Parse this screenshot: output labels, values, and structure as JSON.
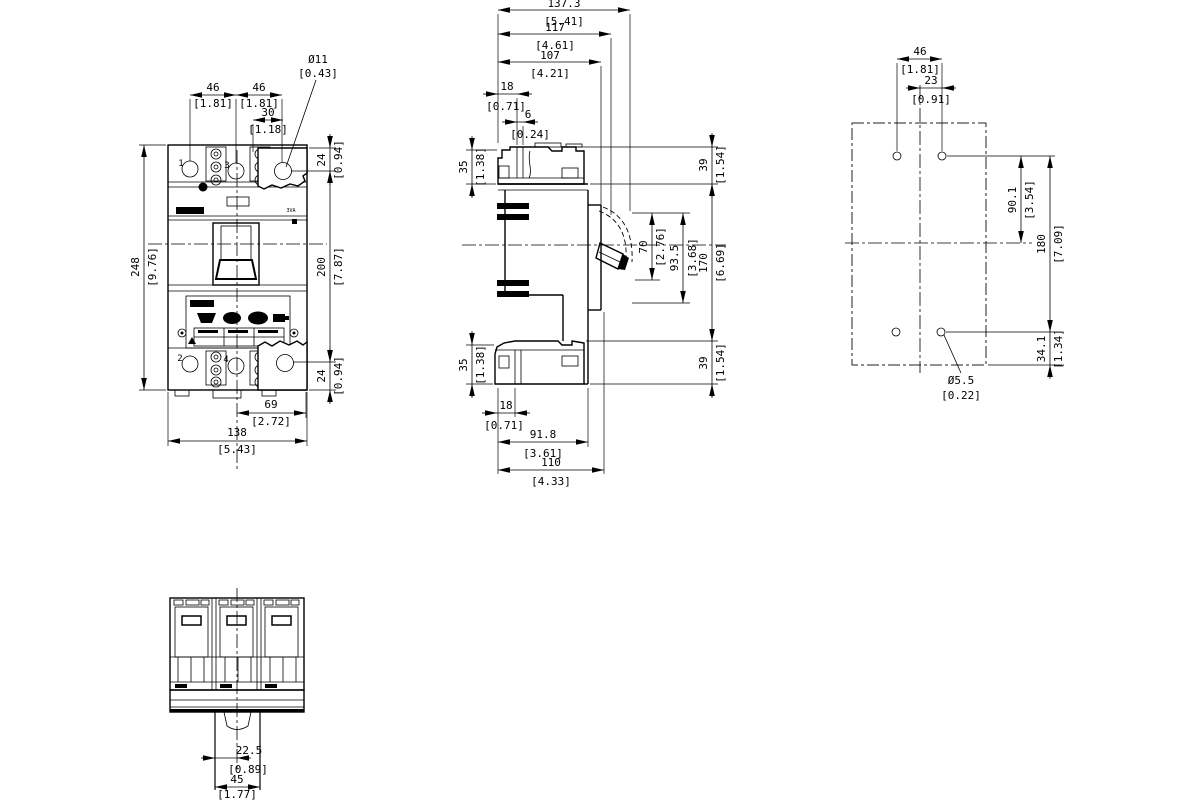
{
  "figure": {
    "type": "technical-dimension-drawing",
    "subject": "3-pole molded case circuit breaker outline drawing: front view, side view, drilling pattern, bottom view",
    "units_note": "dimensions in mm [inch]",
    "line_color": "#000000",
    "background_color": "#ffffff"
  },
  "front_view": {
    "terminals_top": [
      "1",
      "3"
    ],
    "terminals_bottom": [
      "2",
      "4"
    ],
    "product_marking": "3VA",
    "rating_plate_icons": [
      "dsub-connector-icon",
      "round-connector-icon",
      "round-connector-icon",
      "terminal-plug-icon",
      "warning-triangle-icon"
    ],
    "dims": {
      "pitch_left": {
        "mm": "46",
        "inch": "[1.81]"
      },
      "pitch_right": {
        "mm": "46",
        "inch": "[1.81]"
      },
      "ear_hole_offset": {
        "mm": "30",
        "inch": "[1.18]"
      },
      "ear_hole_dia": {
        "mm": "Ø11",
        "inch": "[0.43]"
      },
      "ear_top": {
        "mm": "24",
        "inch": "[0.94]"
      },
      "ear_bottom": {
        "mm": "24",
        "inch": "[0.94]"
      },
      "height_overall": {
        "mm": "248",
        "inch": "[9.76]"
      },
      "height_mounting": {
        "mm": "200",
        "inch": "[7.87]"
      },
      "width_half": {
        "mm": "69",
        "inch": "[2.72]"
      },
      "width_overall": {
        "mm": "138",
        "inch": "[5.43]"
      }
    }
  },
  "side_view": {
    "dims": {
      "depth_overall": {
        "mm": "137.3",
        "inch": "[5.41]"
      },
      "depth_117": {
        "mm": "117",
        "inch": "[4.61]"
      },
      "depth_107": {
        "mm": "107",
        "inch": "[4.21]"
      },
      "top_18": {
        "mm": "18",
        "inch": "[0.71]"
      },
      "top_6": {
        "mm": "6",
        "inch": "[0.24]"
      },
      "terminal_top_35": {
        "mm": "35",
        "inch": "[1.38]"
      },
      "cover_top_39": {
        "mm": "39",
        "inch": "[1.54]"
      },
      "handle_70": {
        "mm": "70",
        "inch": "[2.76]"
      },
      "handle_93_5": {
        "mm": "93.5",
        "inch": "[3.68]"
      },
      "body_170": {
        "mm": "170",
        "inch": "[6.69]"
      },
      "terminal_bottom_35": {
        "mm": "35",
        "inch": "[1.38]"
      },
      "cover_bottom_39": {
        "mm": "39",
        "inch": "[1.54]"
      },
      "bottom_18": {
        "mm": "18",
        "inch": "[0.71]"
      },
      "depth_91_8": {
        "mm": "91.8",
        "inch": "[3.61]"
      },
      "depth_110": {
        "mm": "110",
        "inch": "[4.33]"
      }
    }
  },
  "drilling_pattern": {
    "dims": {
      "hole_pitch_46": {
        "mm": "46",
        "inch": "[1.81]"
      },
      "center_offset_23": {
        "mm": "23",
        "inch": "[0.91]"
      },
      "upper_90_1": {
        "mm": "90.1",
        "inch": "[3.54]"
      },
      "vertical_180": {
        "mm": "180",
        "inch": "[7.09]"
      },
      "lower_34_1": {
        "mm": "34.1",
        "inch": "[1.34]"
      },
      "hole_dia": {
        "mm": "Ø5.5",
        "inch": "[0.22]"
      }
    }
  },
  "bottom_view": {
    "dims": {
      "rail_center_22_5": {
        "mm": "22.5",
        "inch": "[0.89]"
      },
      "rail_width_45": {
        "mm": "45",
        "inch": "[1.77]"
      }
    }
  }
}
